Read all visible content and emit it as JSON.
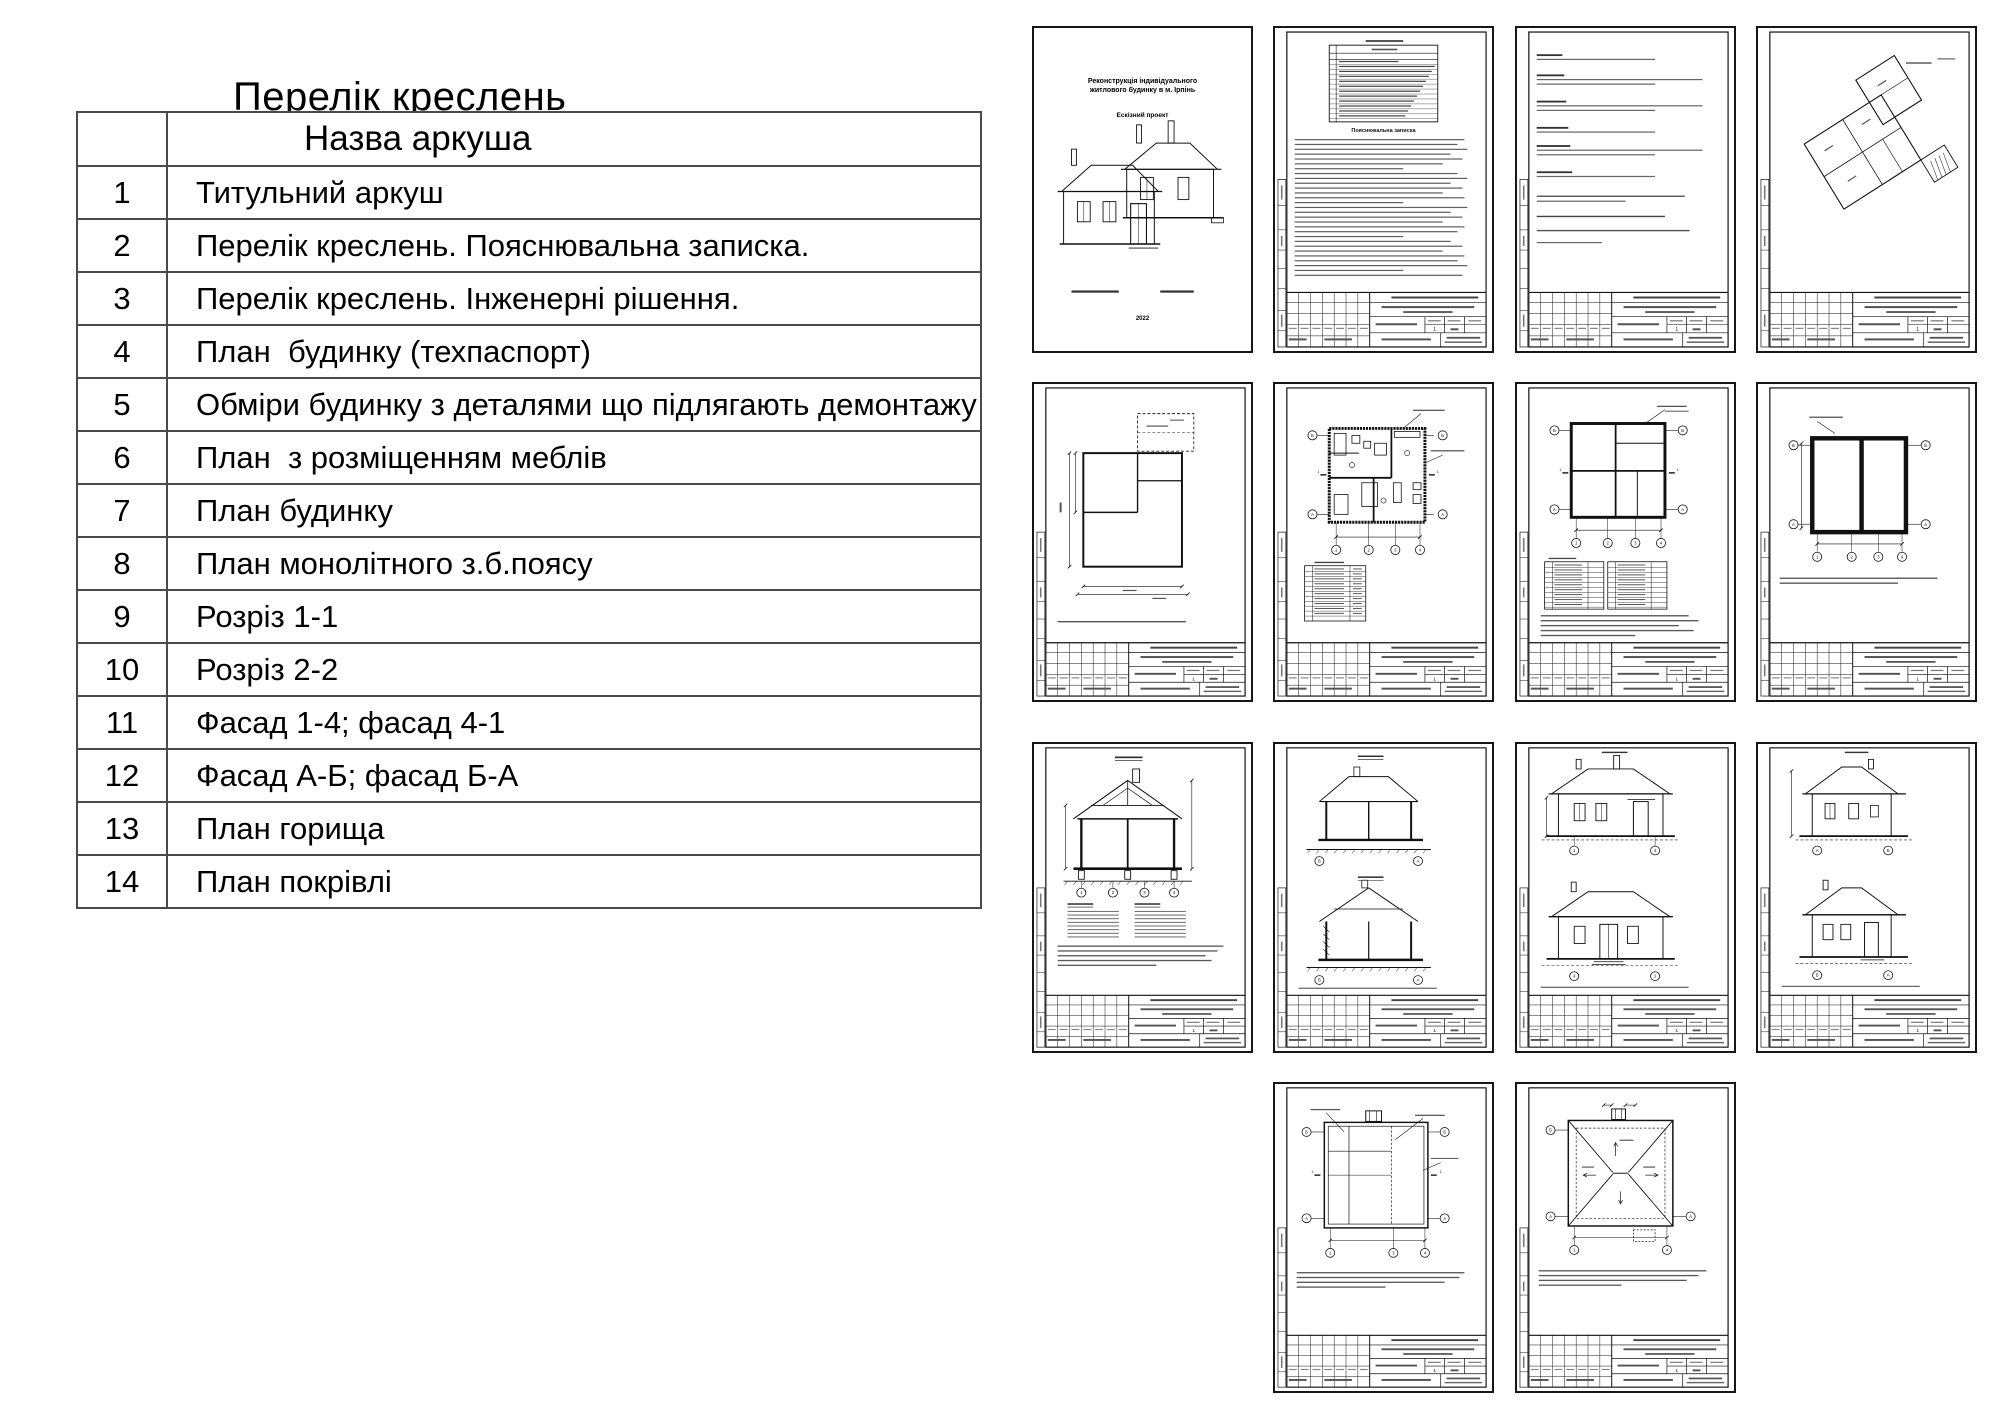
{
  "window": {
    "width": 2000,
    "height": 1414,
    "background": "#ffffff"
  },
  "drawing_list": {
    "title": "Перелік креслень",
    "header": "Назва аркуша",
    "rows": [
      {
        "num": "1",
        "name": "Титульний аркуш"
      },
      {
        "num": "2",
        "name": "Перелік креслень. Пояснювальна записка."
      },
      {
        "num": "3",
        "name": "Перелік креслень. Інженерні рішення."
      },
      {
        "num": "4",
        "name": "План  будинку (техпаспорт)"
      },
      {
        "num": "5",
        "name": "Обміри будинку з деталями що підлягають демонтажу"
      },
      {
        "num": "6",
        "name": "План  з розміщенням меблів"
      },
      {
        "num": "7",
        "name": "План будинку"
      },
      {
        "num": "8",
        "name": "План монолітного з.б.поясу"
      },
      {
        "num": "9",
        "name": "Розріз 1-1"
      },
      {
        "num": "10",
        "name": "Розріз 2-2"
      },
      {
        "num": "11",
        "name": "Фасад 1-4; фасад 4-1"
      },
      {
        "num": "12",
        "name": "Фасад А-Б; фасад Б-А"
      },
      {
        "num": "13",
        "name": "План горища"
      },
      {
        "num": "14",
        "name": "План покрівлі"
      }
    ]
  },
  "title_sheet": {
    "line1": "Реконструкція індивідуального",
    "line2": "житлового будинку в м. Ірпінь",
    "subtitle": "Ескізний проект",
    "year": "2022"
  },
  "sheet_misc": {
    "note_heading": "Пояснювальна записка",
    "stamp_stage_value": "1"
  },
  "axes": {
    "letters": [
      "Б",
      "А"
    ],
    "numbers": [
      "1",
      "2",
      "3",
      "4"
    ]
  },
  "sheets": [
    {
      "num": 1,
      "type": "title",
      "row": 0,
      "col": 0,
      "name": "Титульний аркуш"
    },
    {
      "num": 2,
      "type": "list_note",
      "row": 0,
      "col": 1,
      "name": "Перелік креслень. Пояснювальна записка."
    },
    {
      "num": 3,
      "type": "text_page",
      "row": 0,
      "col": 2,
      "name": "Перелік креслень. Інженерні рішення."
    },
    {
      "num": 4,
      "type": "plan_tech",
      "row": 0,
      "col": 3,
      "name": "План будинку (техпаспорт)"
    },
    {
      "num": 5,
      "type": "plan_measure",
      "row": 1,
      "col": 0,
      "name": "Обміри будинку з деталями що підлягають демонтажу"
    },
    {
      "num": 6,
      "type": "plan_furniture",
      "row": 1,
      "col": 1,
      "name": "План з розміщенням меблів"
    },
    {
      "num": 7,
      "type": "plan_main",
      "row": 1,
      "col": 2,
      "name": "План будинку"
    },
    {
      "num": 8,
      "type": "plan_belt",
      "row": 1,
      "col": 3,
      "name": "План монолітного з.б.поясу"
    },
    {
      "num": 9,
      "type": "section_1",
      "row": 2,
      "col": 0,
      "name": "Розріз 1-1"
    },
    {
      "num": 10,
      "type": "section_2",
      "row": 2,
      "col": 1,
      "name": "Розріз 2-2"
    },
    {
      "num": 11,
      "type": "facade_14",
      "row": 2,
      "col": 2,
      "name": "Фасад 1-4; фасад 4-1"
    },
    {
      "num": 12,
      "type": "facade_ab",
      "row": 2,
      "col": 3,
      "name": "Фасад А-Б; фасад Б-А"
    },
    {
      "num": 13,
      "type": "plan_attic",
      "row": 3,
      "col": 1,
      "name": "План горища"
    },
    {
      "num": 14,
      "type": "plan_roof",
      "row": 3,
      "col": 2,
      "name": "План покрівлі"
    }
  ]
}
